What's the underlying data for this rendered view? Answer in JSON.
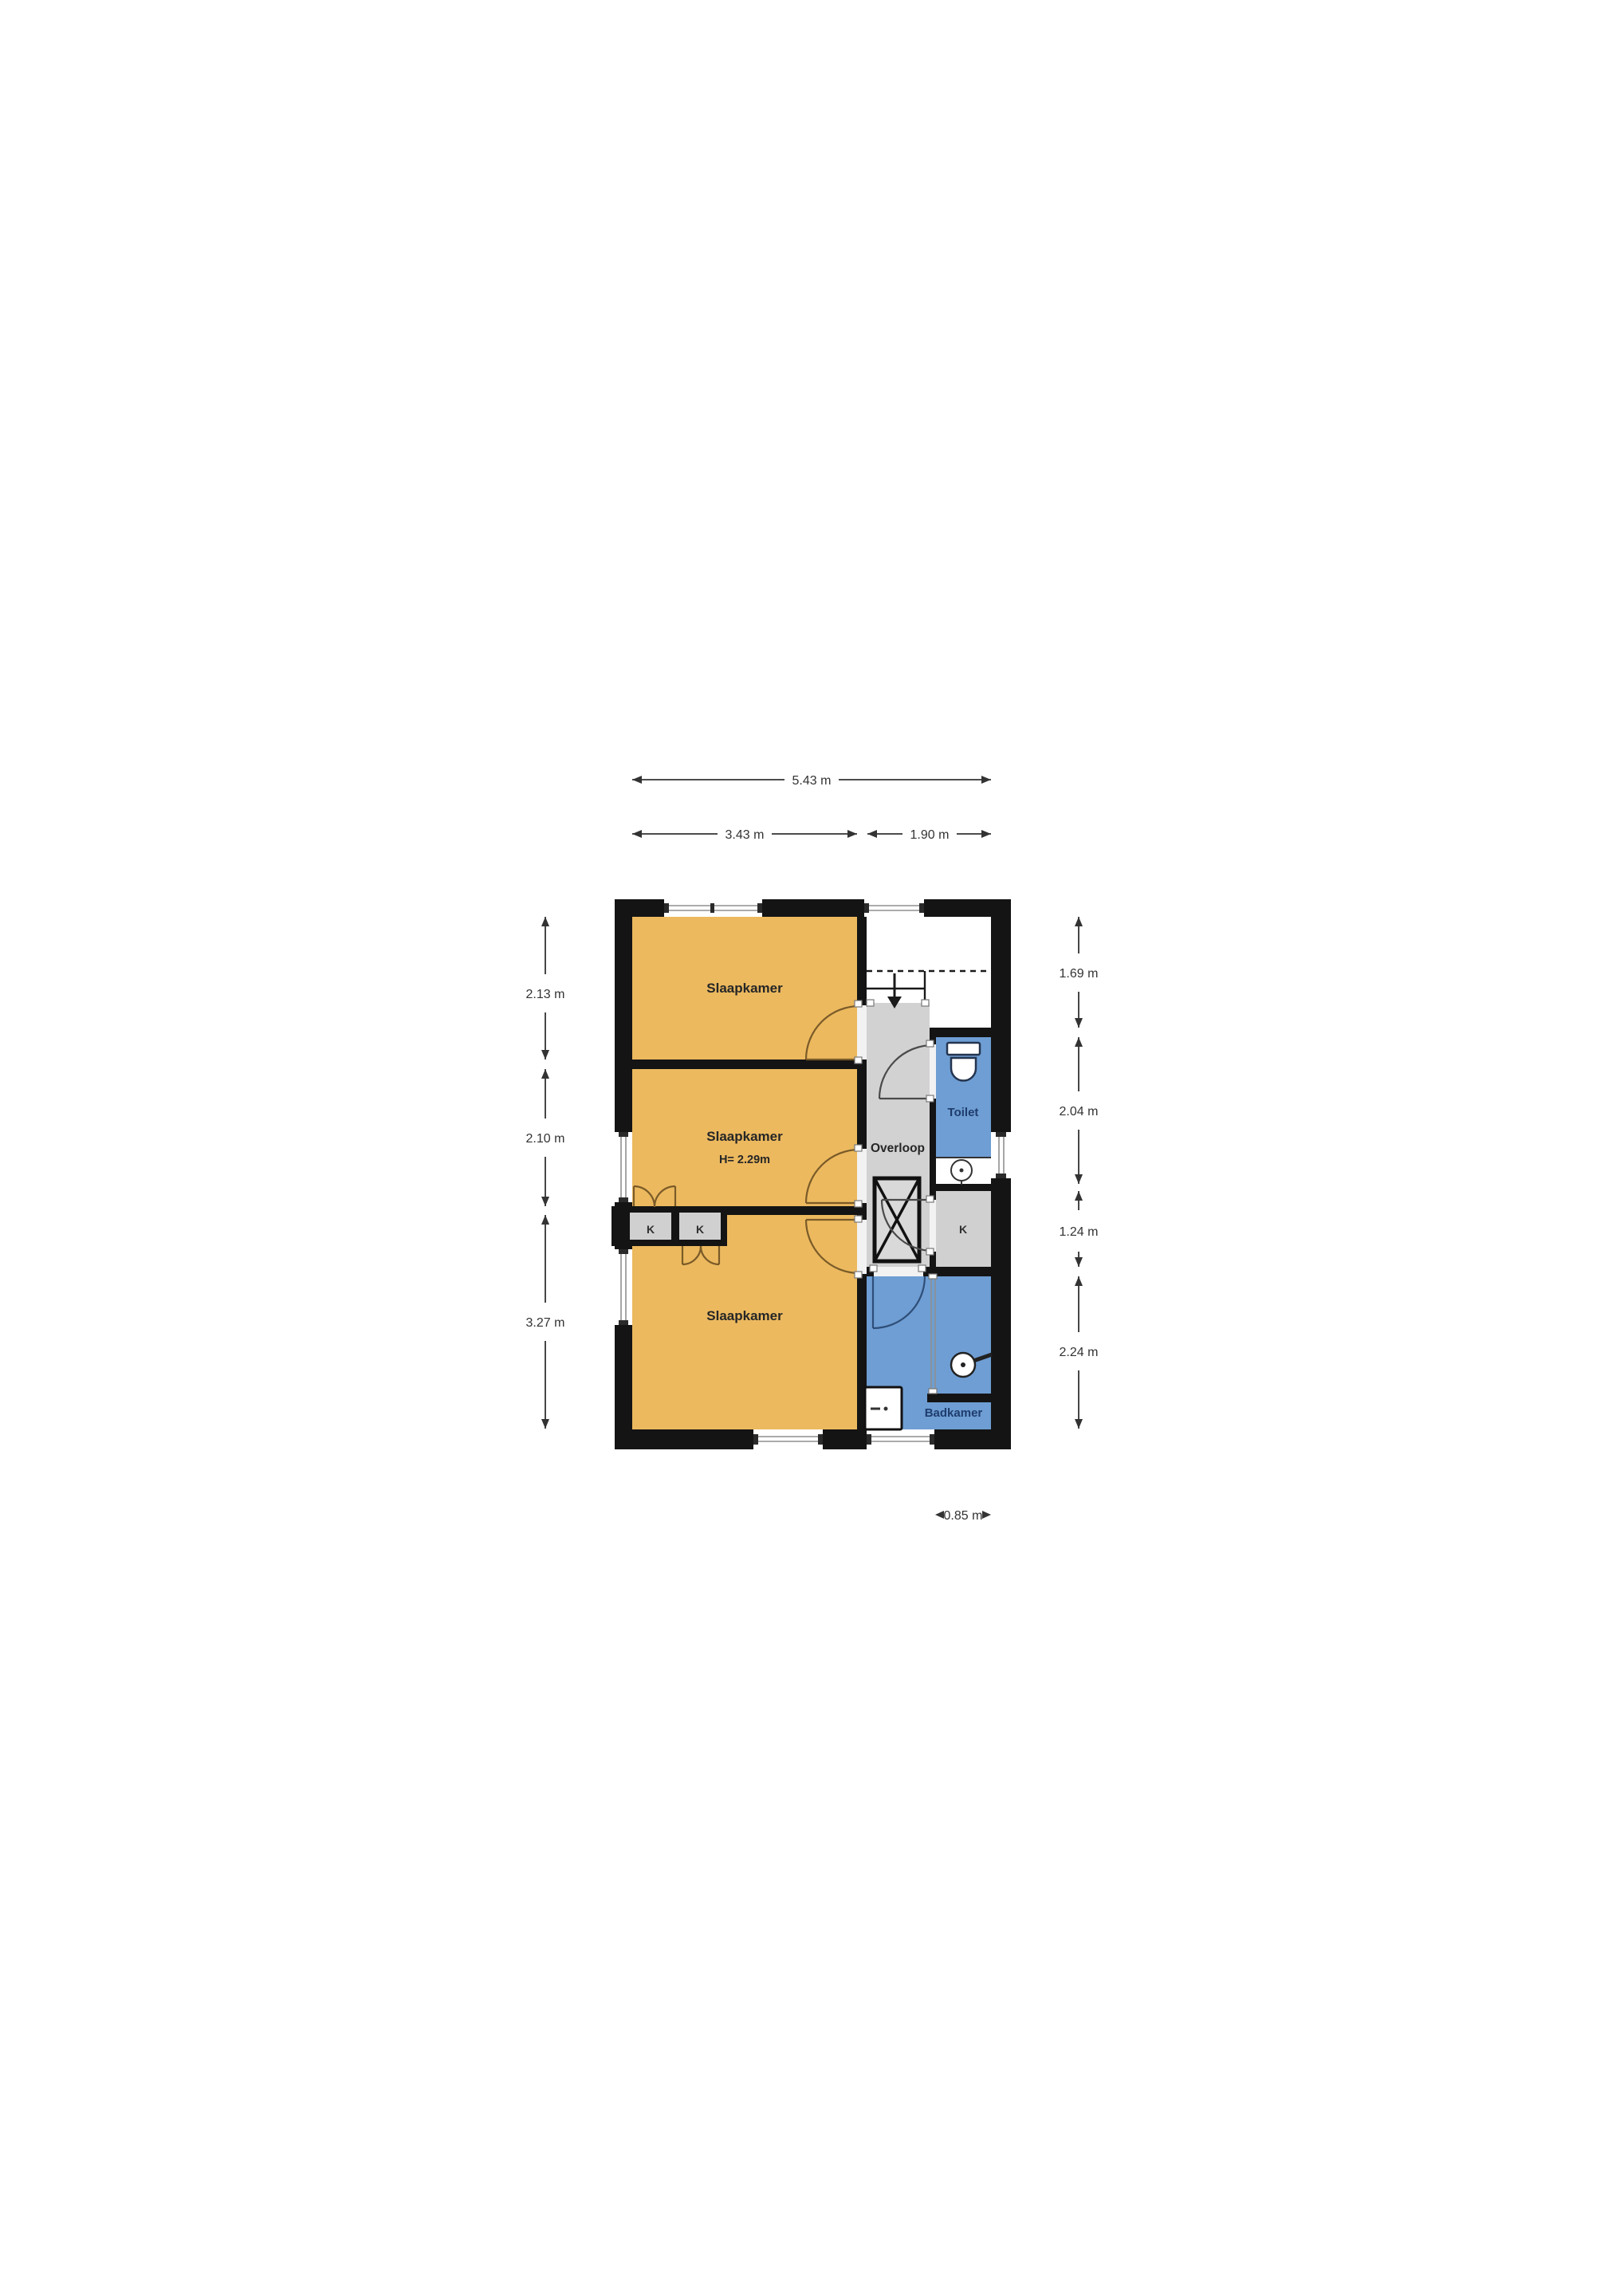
{
  "page": {
    "background": "#FFFFFF",
    "type": "floorplan-drawing"
  },
  "colors": {
    "wall": "#141414",
    "bedroom": "#ECB95F",
    "wet": "#6E9ED3",
    "landing": "#D2D2D2",
    "closet": "#D0D0D0",
    "label_dark": "#262626",
    "label_navy": "#1F3C6D",
    "dim": "#333333",
    "arc_bedroom": "#7A5B28",
    "arc_bath": "#2F4E78",
    "arc_gray": "#4A4A4A",
    "door_gap": "#F2F2F2",
    "glazing": "#8F8F8F",
    "page_bg": "#FFFFFF"
  },
  "floorplan": {
    "rooms": {
      "bedroom_top": {
        "label": "Slaapkamer"
      },
      "bedroom_middle": {
        "label": "Slaapkamer",
        "height_note": "H= 2.29m"
      },
      "bedroom_bottom": {
        "label": "Slaapkamer"
      },
      "landing": {
        "label": "Overloop"
      },
      "toilet": {
        "label": "Toilet"
      },
      "bathroom": {
        "label": "Badkamer"
      },
      "closets": [
        {
          "label": "K"
        },
        {
          "label": "K"
        },
        {
          "label": "K"
        }
      ]
    },
    "dimensions": {
      "top_total": "5.43 m",
      "top_left": "3.43 m",
      "top_right": "1.90 m",
      "left": [
        "2.13 m",
        "2.10 m",
        "3.27 m"
      ],
      "right": [
        "1.69 m",
        "2.04 m",
        "1.24 m",
        "2.24 m"
      ],
      "bottom": "0.85 m"
    },
    "icons": {
      "toilet": "toilet-icon",
      "sink": "round-sink-icon",
      "shower": "shower-head-icon",
      "washbasin": "washbasin-icon",
      "stairs": "stairs-down-arrow-icon",
      "stairwell_void": "stairwell-void-x-icon",
      "closet_doors": "double-swing-door-icon"
    }
  }
}
